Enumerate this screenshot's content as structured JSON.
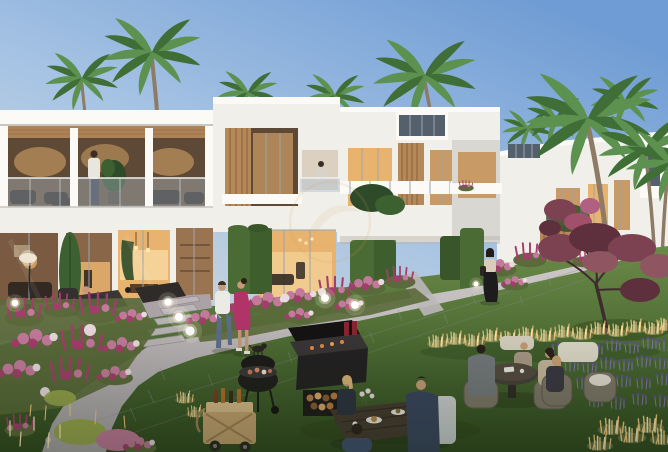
{
  "meta": {
    "description": "Dusk architectural rendering of a modern white townhouse community: palm trees, warmly lit glass facades, and a communal garden where residents stroll, barbecue and dine",
    "time_of_day": "dusk",
    "image_width": 668,
    "image_height": 452
  },
  "watermark": {
    "name": "gold-circle-emblem",
    "position": "center",
    "style": "faint translucent gold ring with leaf swoosh"
  },
  "colors": {
    "sky_top": "#6f9cd4",
    "sky_mid": "#a7c4e4",
    "sky_horizon": "#e6e0d4",
    "bldg": "#f1efe9",
    "bldg_shade": "#d9d7d1",
    "bldg_bright": "#fbfaf6",
    "soffit": "#c9c6c0",
    "terrace_dark": "#5e4936",
    "glow": "#e8b36e",
    "glow_bright": "#f7d9a2",
    "glow_dim": "#c89a66",
    "wood": "#b5885a",
    "wood_dark": "#8a6135",
    "glass": "#b9c7d2",
    "glass_dark": "#54616d",
    "hedge": "#4a6b34",
    "hedge_dark": "#39552a",
    "cypress": "#3c6030",
    "palm1": "#3f6f36",
    "palm2": "#5d9150",
    "trunk": "#8d7b66",
    "lawn1": "#6a8a48",
    "lawn2": "#31491f",
    "lawn3": "#4c6a33",
    "pave": "#bdb7b9",
    "pave_far": "#cdc9c7",
    "joint": "#8f898d",
    "patio": "#aaa2a6",
    "pink": "#c4799c",
    "magenta": "#a23e6b",
    "fl_white": "#ead9df",
    "foliage": "#5a6a3a",
    "chartreuse": "#9aa84e",
    "lav": "#8577b5",
    "lav_dark": "#5f5390",
    "maroon": "#7c4252",
    "maroon_dark": "#5e2f3d",
    "branch": "#3f2a2e",
    "ggrass": "#f2c97e",
    "ggrass_bright": "#ffe9b4",
    "lamp": "#fff3dc",
    "dark": "#26211f",
    "cart": "#c7a370",
    "denim": "#5d6d8a",
    "dress": "#b03468",
    "navy": "#39455f",
    "gray_jkt": "#74787c",
    "beige": "#c6b59c",
    "skin": "#c59a78",
    "wm": "#c8a25e"
  },
  "scene": {
    "buildings": [
      {
        "id": "left-townhouse",
        "floors": 2,
        "features": [
          "open terrace with glass balustrade",
          "timber soffit",
          "lit ground-floor glazing"
        ]
      },
      {
        "id": "center-townhouse",
        "floors": 2,
        "features": [
          "recessed balcony",
          "timber slat screen"
        ]
      },
      {
        "id": "tall-townhouse",
        "floors": 3,
        "features": [
          "clerestory glazing",
          "balconies with white rails"
        ]
      },
      {
        "id": "right-townhouse",
        "floors": 2,
        "features": [
          "warm lit windows",
          "palm cluster in front"
        ]
      }
    ],
    "vegetation": [
      "palm trees",
      "clipped hedges",
      "pink flower beds",
      "lavender rows",
      "maroon ornamental tree",
      "illuminated grasses",
      "cypress"
    ],
    "people": [
      "man standing on terrace",
      "person on balcony",
      "man lounging on patio",
      "couple walking with small dog",
      "woman walking in black skirt",
      "four diners at round table",
      "three diners at rectangular table",
      "woman in corner armchair"
    ],
    "objects": [
      "kettle barbecue",
      "barbecue station with firewood",
      "timber drinks cart",
      "sphere garden lamps",
      "arc floor lamp",
      "stepping-stone path",
      "paved walkway"
    ]
  }
}
